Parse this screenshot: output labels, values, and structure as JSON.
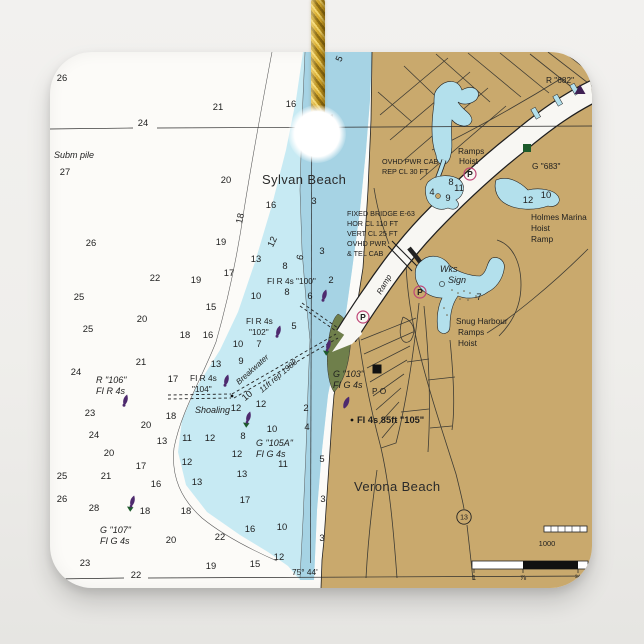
{
  "colors": {
    "background": "#efeeec",
    "tile": "#fcfbf8",
    "water_shallow": "#c7eaf3",
    "water_mid": "#a6d3e4",
    "lagoon": "#b3e0ec",
    "land": "#c9a96d",
    "park_green": "#6f7f4b",
    "channel_white": "#f8f7f3",
    "ink": "#1e1e1e",
    "magenta": "#bf4677",
    "buoy_purple": "#4e2a6e",
    "marker_green": "#1d5b2b",
    "triangle_purple": "#3f2153",
    "cord_gold": "#d8ab2d"
  },
  "map": {
    "labels": [
      {
        "t": "Sylvan Beach",
        "x": 262,
        "y": 184,
        "c": "place"
      },
      {
        "t": "Verona Beach",
        "x": 354,
        "y": 491,
        "c": "place"
      },
      {
        "t": "Subm pile",
        "x": 54,
        "y": 158,
        "c": "it9"
      },
      {
        "t": "Shoaling",
        "x": 195,
        "y": 413,
        "c": "it9"
      },
      {
        "t": "R \"106\"",
        "x": 96,
        "y": 383,
        "c": "it9"
      },
      {
        "t": "FI R 4s",
        "x": 96,
        "y": 394,
        "c": "it9"
      },
      {
        "t": "G \"107\"",
        "x": 100,
        "y": 533,
        "c": "it9"
      },
      {
        "t": "FI G 4s",
        "x": 100,
        "y": 544,
        "c": "it9"
      },
      {
        "t": "G \"105A\"",
        "x": 256,
        "y": 446,
        "c": "it9"
      },
      {
        "t": "FI G 4s",
        "x": 256,
        "y": 457,
        "c": "it9"
      },
      {
        "t": "G \"103\"",
        "x": 333,
        "y": 377,
        "c": "it9"
      },
      {
        "t": "FI G 4s",
        "x": 333,
        "y": 388,
        "c": "it9"
      },
      {
        "t": "Wks",
        "x": 440,
        "y": 272,
        "c": "it9"
      },
      {
        "t": "Sign",
        "x": 448,
        "y": 283,
        "c": "it9"
      },
      {
        "t": "FI R 4s \"100\"",
        "x": 267,
        "y": 284,
        "c": "up8"
      },
      {
        "t": "FI R 4s",
        "x": 246,
        "y": 324,
        "c": "up8"
      },
      {
        "t": "\"102\"",
        "x": 249,
        "y": 335,
        "c": "up8"
      },
      {
        "t": "FI R 4s",
        "x": 190,
        "y": 381,
        "c": "up8"
      },
      {
        "t": "\"104\"",
        "x": 192,
        "y": 392,
        "c": "up8"
      },
      {
        "t": "R \"682\"",
        "x": 546,
        "y": 83,
        "c": "up8"
      },
      {
        "t": "G \"683\"",
        "x": 532,
        "y": 169,
        "c": "up8"
      },
      {
        "t": "Ramps",
        "x": 458,
        "y": 154,
        "c": "up8"
      },
      {
        "t": "Hoist",
        "x": 459,
        "y": 164,
        "c": "up8"
      },
      {
        "t": "Holmes Marina",
        "x": 531,
        "y": 220,
        "c": "up8"
      },
      {
        "t": "Hoist",
        "x": 531,
        "y": 231,
        "c": "up8"
      },
      {
        "t": "Ramp",
        "x": 531,
        "y": 242,
        "c": "up8"
      },
      {
        "t": "Snug Harbour",
        "x": 456,
        "y": 324,
        "c": "up8"
      },
      {
        "t": "Ramps",
        "x": 458,
        "y": 335,
        "c": "up8"
      },
      {
        "t": "Hoist",
        "x": 458,
        "y": 346,
        "c": "up8"
      },
      {
        "t": "P O",
        "x": 372,
        "y": 394,
        "c": "up8"
      },
      {
        "t": "75° 44'",
        "x": 292,
        "y": 575,
        "c": "up8"
      },
      {
        "t": "FI 4s 85ft \"105\"",
        "x": 357,
        "y": 423,
        "c": "navb"
      },
      {
        "t": "OVHD PWR CAB",
        "x": 382,
        "y": 164,
        "c": "up7"
      },
      {
        "t": "REP CL 30 FT",
        "x": 382,
        "y": 174,
        "c": "up7"
      },
      {
        "t": "FIXED BRIDGE E-63",
        "x": 347,
        "y": 216,
        "c": "up7"
      },
      {
        "t": "HOR CL 110 FT",
        "x": 347,
        "y": 226,
        "c": "up7"
      },
      {
        "t": "VERT CL 25 FT",
        "x": 347,
        "y": 236,
        "c": "up7"
      },
      {
        "t": "OVHD PWR",
        "x": 347,
        "y": 246,
        "c": "up7"
      },
      {
        "t": "& TEL CAB",
        "x": 347,
        "y": 256,
        "c": "up7"
      },
      {
        "t": "Breakwater",
        "x": 239,
        "y": 385,
        "c": "it8",
        "r": -42
      },
      {
        "t": "11ft  rep 1988",
        "x": 262,
        "y": 393,
        "c": "it8",
        "r": -40
      },
      {
        "t": "Ramp",
        "x": 381,
        "y": 295,
        "c": "it8",
        "r": -60
      }
    ],
    "soundings": [
      [
        "26",
        62,
        81
      ],
      [
        "21",
        218,
        110
      ],
      [
        "16",
        291,
        107
      ],
      [
        "24",
        143,
        126
      ],
      [
        "27",
        65,
        175
      ],
      [
        "20",
        226,
        183
      ],
      [
        "16",
        271,
        208
      ],
      [
        "3",
        314,
        204
      ],
      [
        "26",
        91,
        246
      ],
      [
        "19",
        221,
        245
      ],
      [
        "13",
        256,
        262
      ],
      [
        "8",
        285,
        269
      ],
      [
        "3",
        322,
        254
      ],
      [
        "22",
        155,
        281
      ],
      [
        "19",
        196,
        283
      ],
      [
        "17",
        229,
        276
      ],
      [
        "2",
        331,
        283
      ],
      [
        "10",
        256,
        299
      ],
      [
        "8",
        287,
        295
      ],
      [
        "6",
        310,
        299
      ],
      [
        "25",
        79,
        300
      ],
      [
        "15",
        211,
        310
      ],
      [
        "20",
        142,
        322
      ],
      [
        "25",
        88,
        332
      ],
      [
        "5",
        294,
        329
      ],
      [
        "18",
        185,
        338
      ],
      [
        "16",
        208,
        338
      ],
      [
        "10",
        238,
        347
      ],
      [
        "7",
        259,
        347
      ],
      [
        "9",
        241,
        364
      ],
      [
        "13",
        216,
        367
      ],
      [
        "21",
        141,
        365
      ],
      [
        "24",
        76,
        375
      ],
      [
        "17",
        173,
        382
      ],
      [
        "23",
        90,
        416
      ],
      [
        "20",
        146,
        428
      ],
      [
        "18",
        171,
        419
      ],
      [
        "12",
        236,
        411
      ],
      [
        "12",
        261,
        407
      ],
      [
        "2",
        306,
        411
      ],
      [
        "24",
        94,
        438
      ],
      [
        "13",
        162,
        444
      ],
      [
        "11",
        187,
        441
      ],
      [
        "12",
        210,
        441
      ],
      [
        "8",
        243,
        439
      ],
      [
        "10",
        272,
        432
      ],
      [
        "4",
        307,
        430
      ],
      [
        "20",
        109,
        456
      ],
      [
        "12",
        237,
        457
      ],
      [
        "17",
        141,
        469
      ],
      [
        "12",
        187,
        465
      ],
      [
        "11",
        283,
        467
      ],
      [
        "5",
        322,
        462
      ],
      [
        "25",
        62,
        479
      ],
      [
        "21",
        106,
        479
      ],
      [
        "16",
        156,
        487
      ],
      [
        "13",
        197,
        485
      ],
      [
        "13",
        242,
        477
      ],
      [
        "26",
        62,
        502
      ],
      [
        "28",
        94,
        511
      ],
      [
        "18",
        145,
        514
      ],
      [
        "18",
        186,
        514
      ],
      [
        "17",
        245,
        503
      ],
      [
        "16",
        250,
        532
      ],
      [
        "10",
        282,
        530
      ],
      [
        "3",
        323,
        502
      ],
      [
        "3",
        322,
        541
      ],
      [
        "23",
        85,
        566
      ],
      [
        "19",
        211,
        569
      ],
      [
        "15",
        255,
        567
      ],
      [
        "12",
        279,
        560
      ],
      [
        "20",
        171,
        543
      ],
      [
        "22",
        220,
        540
      ],
      [
        "1",
        332,
        121
      ],
      [
        "8",
        451,
        185
      ],
      [
        "11",
        459,
        191
      ],
      [
        "4",
        432,
        195
      ],
      [
        "9",
        448,
        201
      ],
      [
        "12",
        528,
        203
      ],
      [
        "10",
        546,
        198
      ],
      [
        "7",
        479,
        300
      ],
      [
        "5",
        342,
        60,
        -65
      ],
      [
        "18",
        243,
        219,
        -78
      ],
      [
        "12",
        275,
        243,
        -65
      ],
      [
        "6",
        303,
        258,
        -78
      ],
      [
        "10",
        249,
        398,
        -40
      ],
      [
        "22",
        136,
        578,
        0
      ]
    ],
    "symbols": [
      {
        "k": "buoy-r",
        "x": 124,
        "y": 404
      },
      {
        "k": "buoy-r",
        "x": 323,
        "y": 299
      },
      {
        "k": "buoy-r",
        "x": 277,
        "y": 335
      },
      {
        "k": "buoy-r",
        "x": 225,
        "y": 384
      },
      {
        "k": "buoy-g",
        "x": 131,
        "y": 505
      },
      {
        "k": "buoy-g",
        "x": 247,
        "y": 421
      },
      {
        "k": "buoy-g",
        "x": 327,
        "y": 349
      },
      {
        "k": "light",
        "x": 344,
        "y": 407
      },
      {
        "k": "dot",
        "x": 352,
        "y": 420
      },
      {
        "k": "dot",
        "x": 232,
        "y": 396
      },
      {
        "k": "tri",
        "x": 580,
        "y": 90
      },
      {
        "k": "sq-green",
        "x": 527,
        "y": 148
      },
      {
        "k": "sq-black",
        "x": 377,
        "y": 369
      },
      {
        "k": "parking",
        "x": 470,
        "y": 174,
        "t": "P"
      },
      {
        "k": "parking",
        "x": 420,
        "y": 292,
        "t": "P"
      },
      {
        "k": "parking",
        "x": 363,
        "y": 317,
        "t": "P"
      },
      {
        "k": "shield",
        "x": 464,
        "y": 517,
        "t": "13"
      },
      {
        "k": "ring",
        "x": 442,
        "y": 284
      }
    ],
    "scale": {
      "yards_label": "1000",
      "mile_ticks": [
        {
          "t": "1",
          "x": 474,
          "y": 580
        },
        {
          "t": "⅞",
          "x": 523,
          "y": 580
        },
        {
          "t": "¾",
          "x": 578,
          "y": 580
        }
      ]
    }
  }
}
